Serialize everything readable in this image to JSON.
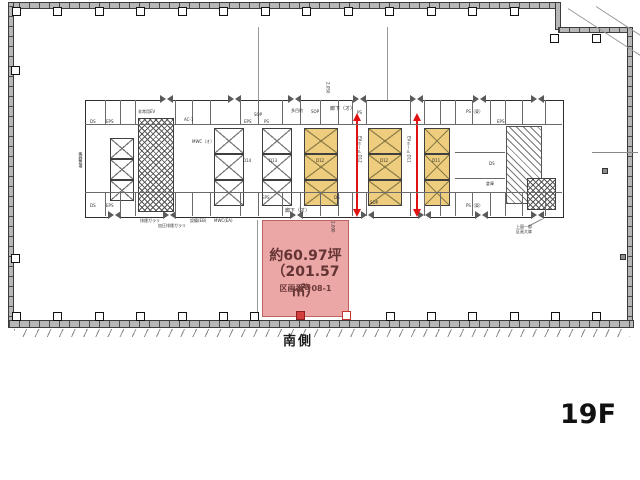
{
  "floor_plan": {
    "floor_label": "19F",
    "orientation_label": "南側",
    "parcel": {
      "area_tsubo": "約60.97坪",
      "area_sqm": "（201.57㎡）",
      "section_label": "区画番号08-1",
      "fill_color": "#eba6a6",
      "text_color": "#643434"
    },
    "colors": {
      "elevator_highlight": "#eecd7f",
      "arrow_red": "#e01212",
      "wall_gray": "#b7b7b7",
      "column_red": "#d23d3d"
    },
    "labels": [
      {
        "t": "多目的",
        "x": 291,
        "y": 109
      },
      {
        "t": "SOP",
        "x": 311,
        "y": 110
      },
      {
        "t": "廊下（オ）",
        "x": 330,
        "y": 107,
        "s": 5
      },
      {
        "t": "PS",
        "x": 357,
        "y": 111
      },
      {
        "t": "非常用EV",
        "x": 138,
        "y": 110
      },
      {
        "t": "AC-1",
        "x": 184,
        "y": 118
      },
      {
        "t": "EPS",
        "x": 106,
        "y": 120
      },
      {
        "t": "DS",
        "x": 90,
        "y": 120
      },
      {
        "t": "EPS",
        "x": 106,
        "y": 204
      },
      {
        "t": "DS",
        "x": 90,
        "y": 204
      },
      {
        "t": "MWC（オ）",
        "x": 192,
        "y": 140
      },
      {
        "t": "SOP",
        "x": 254,
        "y": 113
      },
      {
        "t": "EPS",
        "x": 244,
        "y": 120
      },
      {
        "t": "PS",
        "x": 264,
        "y": 120
      },
      {
        "t": "EPS",
        "x": 262,
        "y": 196
      },
      {
        "t": "DS",
        "x": 334,
        "y": 196
      },
      {
        "t": "廊下（オ）",
        "x": 285,
        "y": 209,
        "s": 5
      },
      {
        "t": "SOP",
        "x": 370,
        "y": 201
      },
      {
        "t": "PS（東）",
        "x": 466,
        "y": 110
      },
      {
        "t": "PS（東）",
        "x": 466,
        "y": 204
      },
      {
        "t": "EPS",
        "x": 497,
        "y": 120
      },
      {
        "t": "DS",
        "x": 489,
        "y": 162
      },
      {
        "t": "倉庫",
        "x": 486,
        "y": 182
      },
      {
        "t": "排煙ガラリ",
        "x": 140,
        "y": 219
      },
      {
        "t": "加圧排煙ガラリ",
        "x": 158,
        "y": 224
      },
      {
        "t": "設備(EB)",
        "x": 190,
        "y": 219
      },
      {
        "t": "MWC(EA)",
        "x": 214,
        "y": 219
      },
      {
        "t": "D14",
        "x": 243,
        "y": 159
      },
      {
        "t": "D13",
        "x": 269,
        "y": 159
      },
      {
        "t": "D12",
        "x": 316,
        "y": 159
      },
      {
        "t": "D12",
        "x": 380,
        "y": 159
      },
      {
        "t": "D11",
        "x": 432,
        "y": 159
      },
      {
        "t": "EVホール D12",
        "x": 357,
        "y": 136,
        "v": true
      },
      {
        "t": "EVホール D11",
        "x": 406,
        "y": 136,
        "v": true
      },
      {
        "t": "機器置場",
        "x": 78,
        "y": 152,
        "v": true
      },
      {
        "t": "2,050",
        "x": 325,
        "y": 82,
        "v": true
      },
      {
        "t": "2,090",
        "x": 330,
        "y": 221,
        "v": true
      },
      {
        "t": "上図一部",
        "x": 516,
        "y": 225
      },
      {
        "t": "区画大扉",
        "x": 516,
        "y": 230
      }
    ],
    "geometry": {
      "columns": [
        {
          "x": 12,
          "y": 7
        },
        {
          "x": 53,
          "y": 7
        },
        {
          "x": 95,
          "y": 7
        },
        {
          "x": 136,
          "y": 7
        },
        {
          "x": 178,
          "y": 7
        },
        {
          "x": 219,
          "y": 7
        },
        {
          "x": 261,
          "y": 7
        },
        {
          "x": 302,
          "y": 7
        },
        {
          "x": 344,
          "y": 7
        },
        {
          "x": 385,
          "y": 7
        },
        {
          "x": 427,
          "y": 7
        },
        {
          "x": 468,
          "y": 7
        },
        {
          "x": 510,
          "y": 7
        },
        {
          "x": 550,
          "y": 34
        },
        {
          "x": 592,
          "y": 34
        },
        {
          "x": 11,
          "y": 66
        },
        {
          "x": 11,
          "y": 254
        },
        {
          "x": 12,
          "y": 312
        },
        {
          "x": 53,
          "y": 312
        },
        {
          "x": 95,
          "y": 312
        },
        {
          "x": 136,
          "y": 312
        },
        {
          "x": 178,
          "y": 312
        },
        {
          "x": 219,
          "y": 312
        },
        {
          "x": 250,
          "y": 312
        },
        {
          "x": 386,
          "y": 312
        },
        {
          "x": 427,
          "y": 312
        },
        {
          "x": 468,
          "y": 312
        },
        {
          "x": 510,
          "y": 312
        },
        {
          "x": 551,
          "y": 312
        },
        {
          "x": 592,
          "y": 312
        },
        {
          "x": 620,
          "y": 254,
          "variant": "small"
        },
        {
          "x": 602,
          "y": 168,
          "variant": "small"
        },
        {
          "x": 296,
          "y": 311,
          "variant": "red-filled"
        },
        {
          "x": 342,
          "y": 311,
          "variant": "red-outline"
        }
      ],
      "doors_top_xs": [
        160,
        228,
        288,
        353,
        410,
        473,
        531
      ],
      "doors_top_y": 95,
      "doors_bottom_xs": [
        108,
        163,
        290,
        361,
        418,
        475,
        531
      ],
      "doors_bottom_y": 211,
      "banks": [
        {
          "x": 110,
          "y": 138,
          "w": 24,
          "carH": 21,
          "n": 3,
          "c": "white"
        },
        {
          "x": 214,
          "y": 128,
          "w": 30,
          "carH": 26,
          "n": 3,
          "c": "white"
        },
        {
          "x": 262,
          "y": 128,
          "w": 30,
          "carH": 26,
          "n": 3,
          "c": "white"
        },
        {
          "x": 304,
          "y": 128,
          "w": 34,
          "carH": 26,
          "n": 3,
          "c": "yellow"
        },
        {
          "x": 368,
          "y": 128,
          "w": 34,
          "carH": 26,
          "n": 3,
          "c": "yellow"
        },
        {
          "x": 424,
          "y": 128,
          "w": 26,
          "carH": 26,
          "n": 3,
          "c": "yellow"
        }
      ],
      "hatches": [
        {
          "x": 138,
          "y": 118,
          "w": 34,
          "h": 92,
          "t": "cross"
        },
        {
          "x": 506,
          "y": 126,
          "w": 34,
          "h": 76,
          "t": "diag"
        },
        {
          "x": 527,
          "y": 178,
          "w": 27,
          "h": 30,
          "t": "cross"
        }
      ],
      "arrows": [
        {
          "x": 356
        },
        {
          "x": 416
        }
      ],
      "arrow_y1": 121,
      "arrow_y2": 209,
      "partition_xs": [
        105,
        120,
        135,
        175,
        192,
        210,
        240,
        258,
        282,
        300,
        320,
        338,
        352,
        366,
        410,
        424,
        440,
        455,
        472,
        490,
        505,
        522,
        545
      ],
      "strip_top": {
        "y1": 100,
        "y2": 124
      },
      "strip_bottom": {
        "y1": 192,
        "y2": 216
      },
      "core_hlines": [
        {
          "x1": 85,
          "x2": 562,
          "y": 124
        },
        {
          "x1": 85,
          "x2": 562,
          "y": 192
        },
        {
          "x1": 455,
          "x2": 505,
          "y": 152
        },
        {
          "x1": 455,
          "x2": 505,
          "y": 178
        }
      ],
      "dim_lines": [
        {
          "x": 258,
          "y1": 27,
          "y2": 100
        },
        {
          "x": 387,
          "y1": 27,
          "y2": 100
        },
        {
          "x": 257,
          "y1": 220,
          "y2": 312
        }
      ]
    }
  }
}
